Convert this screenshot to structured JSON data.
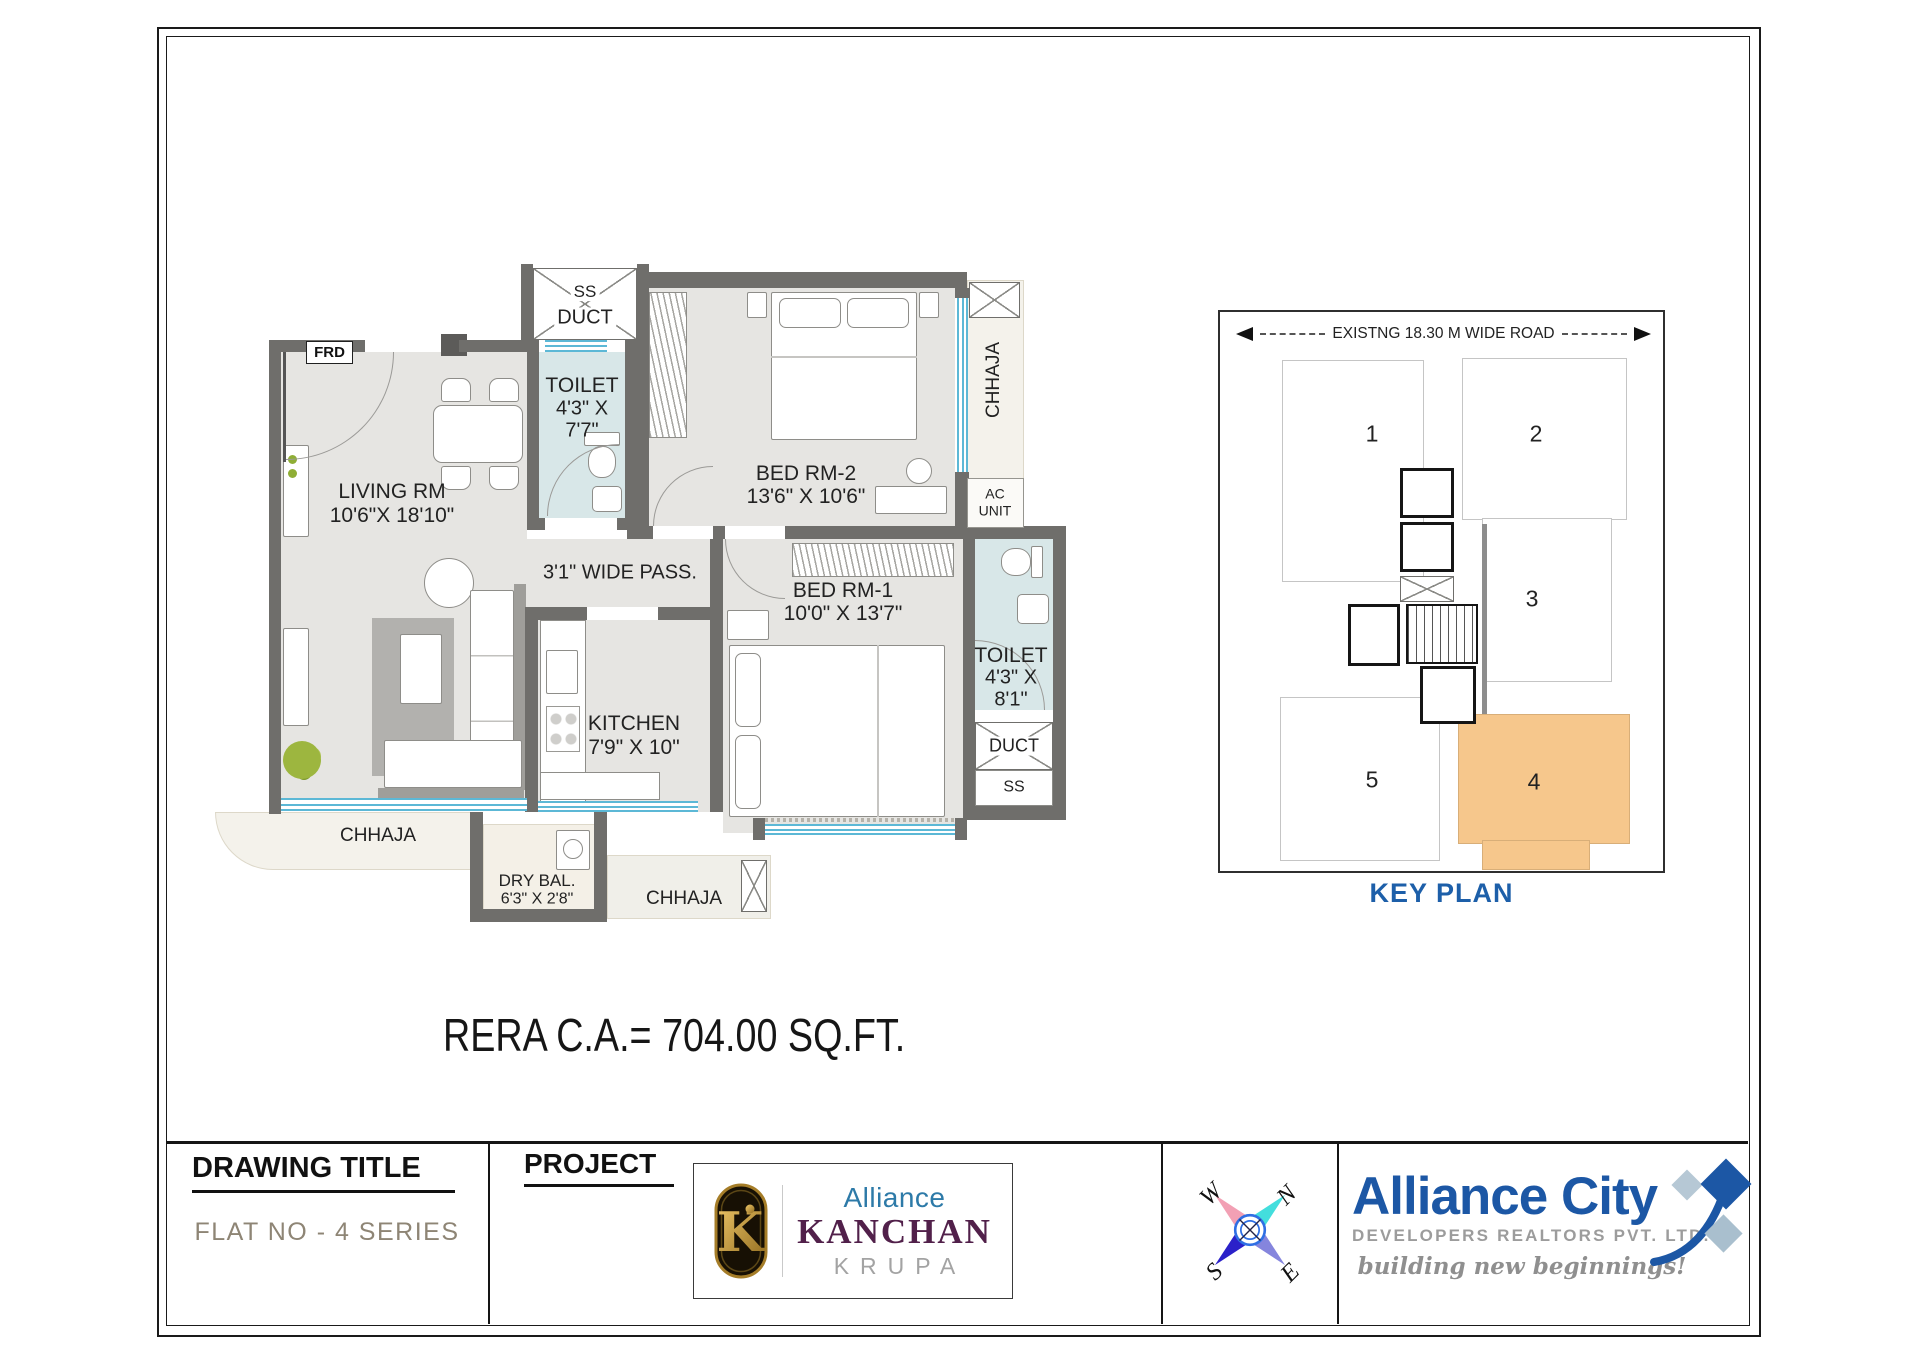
{
  "plan": {
    "entry": {
      "frd": "FRD"
    },
    "ducts": {
      "ss_top": "SS",
      "duct_top": "DUCT",
      "duct_right": "DUCT",
      "ss_right": "SS"
    },
    "chhaja": {
      "right": "CHHAJA",
      "left": "CHHAJA",
      "bottom": "CHHAJA"
    },
    "ac_unit": {
      "line1": "AC",
      "line2": "UNIT"
    },
    "rooms": {
      "living": {
        "name": "LIVING RM",
        "dims": "10'6\"X 18'10\""
      },
      "toilet1": {
        "name": "TOILET",
        "dims1": "4'3\" X",
        "dims2": "7'7\""
      },
      "bed2": {
        "name": "BED RM-2",
        "dims": "13'6\" X 10'6\""
      },
      "bed1": {
        "name": "BED RM-1",
        "dims": "10'0\" X 13'7\""
      },
      "kitchen": {
        "name": "KITCHEN",
        "dims": "7'9\" X 10\""
      },
      "toilet2": {
        "name": "TOILET",
        "dims1": "4'3\" X",
        "dims2": "8'1\""
      },
      "dry_balcony": {
        "name": "DRY BAL.",
        "dims": "6'3\" X 2'8\""
      },
      "passage": {
        "name": "3'1\" WIDE PASS."
      }
    },
    "rera_area_text": "RERA C.A.= 704.00 SQ.FT."
  },
  "key_plan": {
    "road_label": "EXISTNG 18.30 M WIDE ROAD",
    "title": "KEY PLAN",
    "units": {
      "u1": "1",
      "u2": "2",
      "u3": "3",
      "u4": "4",
      "u5": "5"
    },
    "highlighted_unit": "4",
    "highlight_color": "#F6C78C"
  },
  "title_block": {
    "drawing_title": {
      "label": "DRAWING TITLE",
      "value": "FLAT NO - 4 SERIES"
    },
    "project": {
      "label": "PROJECT"
    },
    "project_logo": {
      "monogram": "K",
      "brand": "Alliance",
      "name": "KANCHAN",
      "subname": "KRUPA"
    },
    "compass": {
      "north": "N",
      "east": "E",
      "south": "S",
      "west": "W"
    },
    "company": {
      "name": "Alliance City",
      "subtitle": "DEVELOPERS REALTORS PVT. LTD.",
      "tagline": "building new beginnings!"
    }
  }
}
